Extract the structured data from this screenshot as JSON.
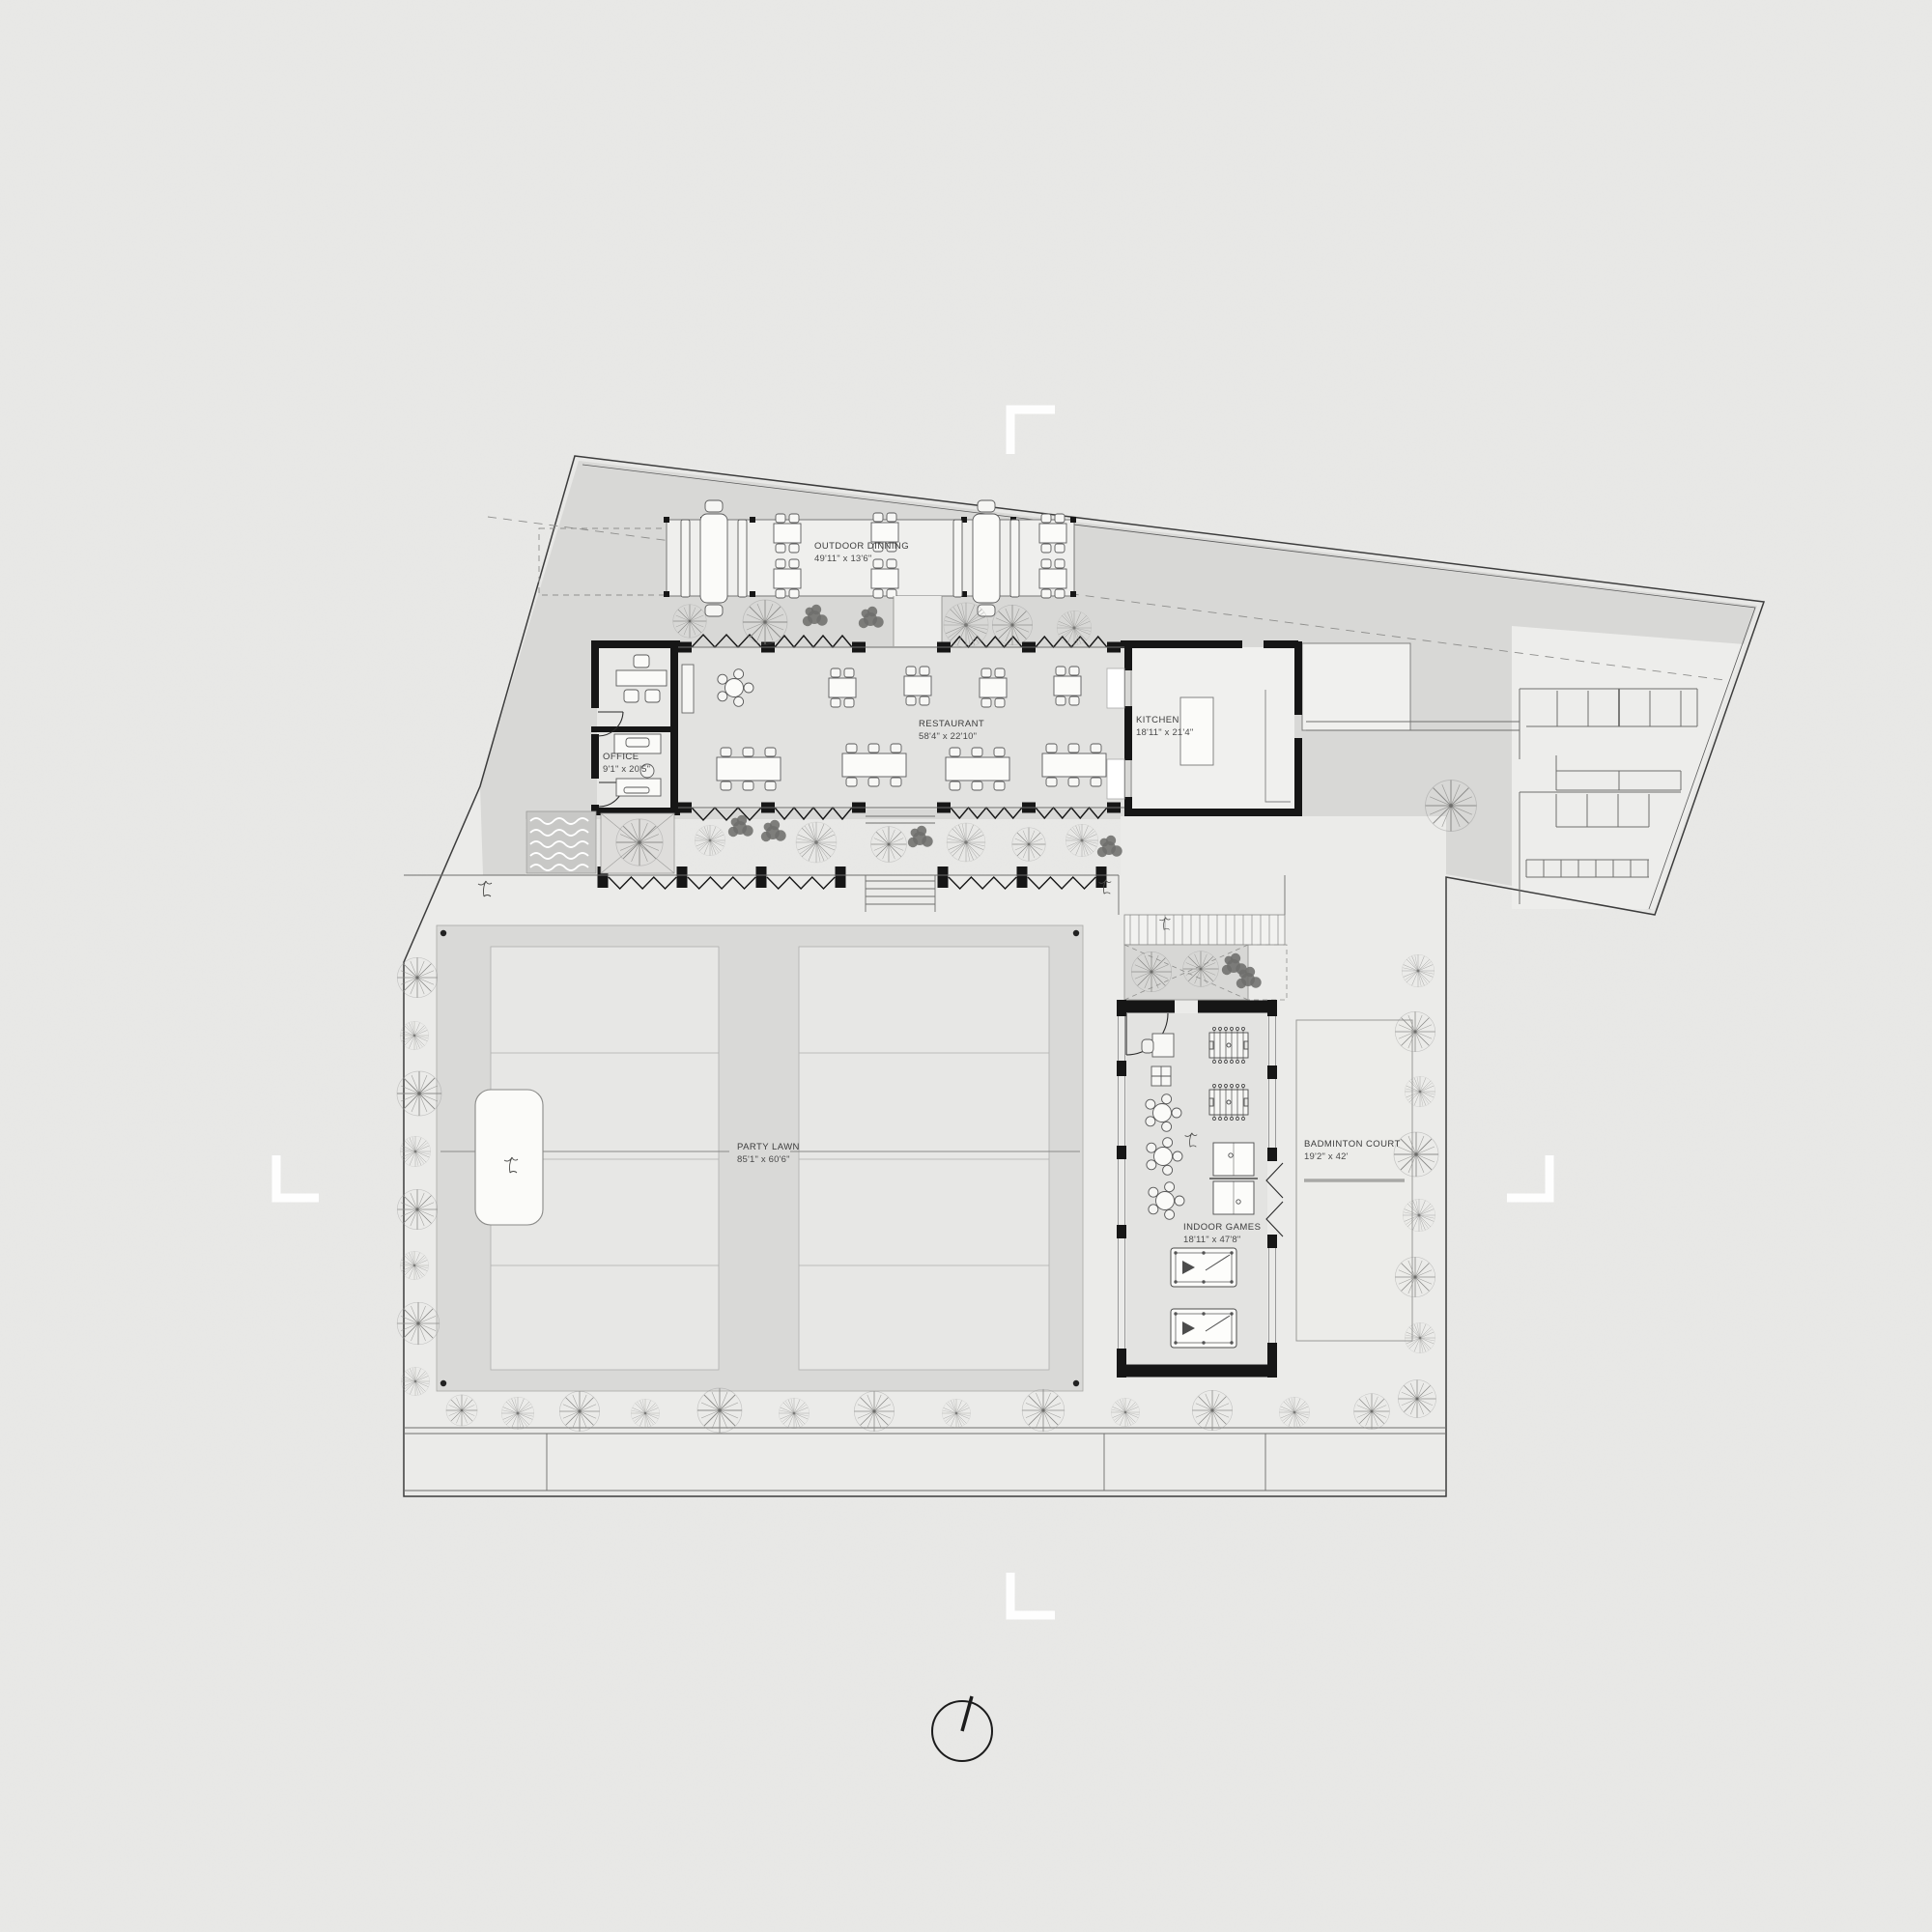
{
  "drawing": {
    "kind": "architectural site plan",
    "rooms": [
      {
        "id": "outdoor-dining",
        "name": "OUTDOOR DINNING",
        "dims": "49'11\" x 13'6\""
      },
      {
        "id": "restaurant",
        "name": "RESTAURANT",
        "dims": "58'4\" x 22'10\""
      },
      {
        "id": "kitchen",
        "name": "KITCHEN",
        "dims": "18'11\" x 21'4\""
      },
      {
        "id": "office",
        "name": "OFFICE",
        "dims": "9'1\" x 20'5\""
      },
      {
        "id": "party-lawn",
        "name": "PARTY LAWN",
        "dims": "85'1\" x 60'6\""
      },
      {
        "id": "indoor-games",
        "name": "INDOOR GAMES",
        "dims": "18'11\" x 47'8\""
      },
      {
        "id": "badminton-court",
        "name": "BADMINTON COURT",
        "dims": "19'2\" x 42'"
      }
    ],
    "icons": {
      "north_indicator": "circle-with-needle",
      "crop_marks": "white-corner-marks",
      "trees": [
        "branch-tree",
        "dandelion-tree",
        "dark-bush"
      ],
      "bird": "small-bird-sketch"
    },
    "colors": {
      "paper": "#e9e9e7",
      "paving_dark": "#d8d8d6",
      "surface_light": "#ebebe9",
      "room_fill": "#e2e2e0",
      "lawn_fill": "#d9d9d7",
      "panel_fill": "#e7e7e5",
      "wall": "#161616",
      "label_text": "#3c3c3c",
      "water": "#c8c8c6"
    }
  }
}
